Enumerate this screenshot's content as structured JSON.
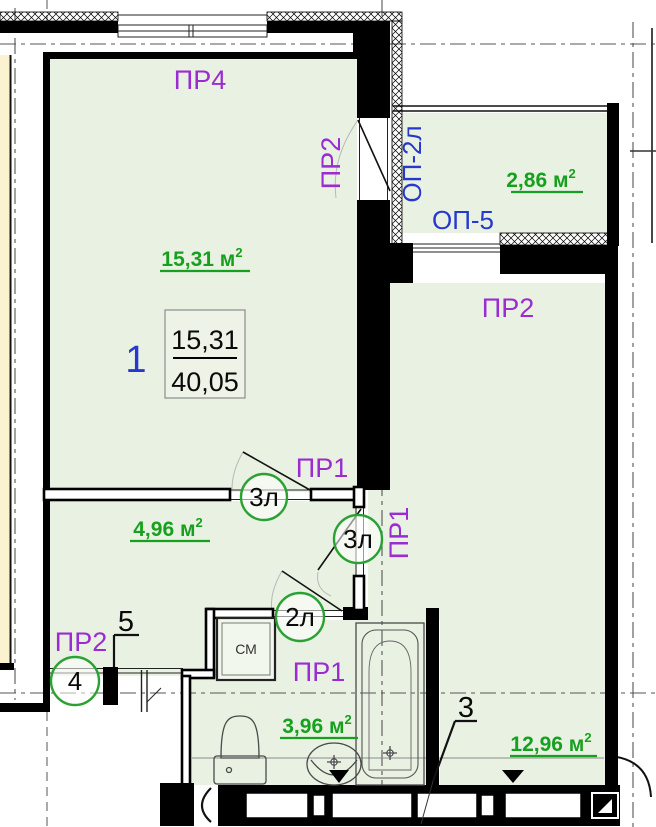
{
  "plan": {
    "type": "apartment-floor-plan"
  },
  "rooms": {
    "living": {
      "number": "1",
      "area": "15,31 м",
      "area_sup": "2",
      "spec_top": "15,31",
      "spec_bottom": "40,05"
    },
    "hallway": {
      "area": "4,96 м",
      "area_sup": "2"
    },
    "bathroom": {
      "area": "3,96 м",
      "area_sup": "2"
    },
    "kitchen_living": {
      "area": "12,96 м",
      "area_sup": "2"
    },
    "balcony": {
      "area": "2,86 м",
      "area_sup": "2"
    }
  },
  "openings": {
    "pr4": "ПР4",
    "pr2": "ПР2",
    "pr1": "ПР1",
    "op_2l": "ОП-2л",
    "op_5": "ОП-5"
  },
  "door_marks": {
    "d3l": "3л",
    "d2l": "2л",
    "d4": "4"
  },
  "callouts": {
    "five": "5",
    "three": "3"
  },
  "equipment": {
    "washing_machine": "СМ"
  },
  "colors": {
    "room_fill": "#e9f1e3",
    "neighbor_fill": "#fbf3d0",
    "label_purple": "#9a2cd1",
    "label_blue": "#2639cc",
    "area_green": "#17a01e",
    "wall": "#000000"
  }
}
